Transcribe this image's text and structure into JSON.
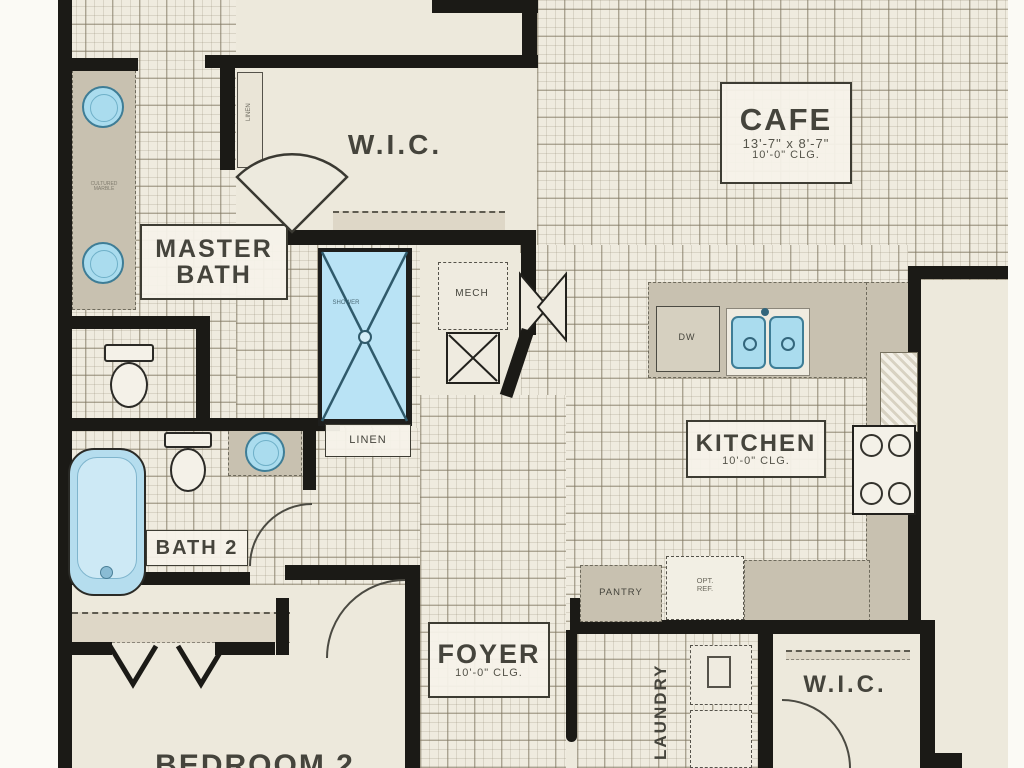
{
  "plan": {
    "rooms": {
      "cafe": {
        "name": "CAFE",
        "dims": "13'-7\" x 8'-7\"",
        "clg": "10'-0\" CLG."
      },
      "wic_top": {
        "name": "W.I.C."
      },
      "master_bath": {
        "line1": "MASTER",
        "line2": "BATH"
      },
      "kitchen": {
        "name": "KITCHEN",
        "clg": "10'-0\" CLG."
      },
      "bath2": {
        "name": "BATH 2"
      },
      "foyer": {
        "name": "FOYER",
        "clg": "10'-0\" CLG."
      },
      "laundry": {
        "name": "LAUNDRY"
      },
      "wic_bottom": {
        "name": "W.I.C."
      },
      "bedroom2": {
        "name": "BEDROOM 2"
      }
    },
    "labels": {
      "linen_cabinet": "LINEN",
      "linen_closet": "LINEN",
      "mech": "MECH",
      "pantry": "PANTRY",
      "opt_ref_line1": "OPT.",
      "opt_ref_line2": "REF.",
      "dishwasher": "DW",
      "shower": "SHOWER",
      "vanity_note_line1": "CULTURED",
      "vanity_note_line2": "MARBLE"
    },
    "colors": {
      "wall": "#1b1a16",
      "floor": "#ede9dc",
      "tile_line": "#7d745f",
      "counter": "#c8c1b0",
      "fixture_blue": "#aadcee",
      "fixture_blue_stroke": "#3e7d96",
      "text": "#45443c"
    }
  }
}
